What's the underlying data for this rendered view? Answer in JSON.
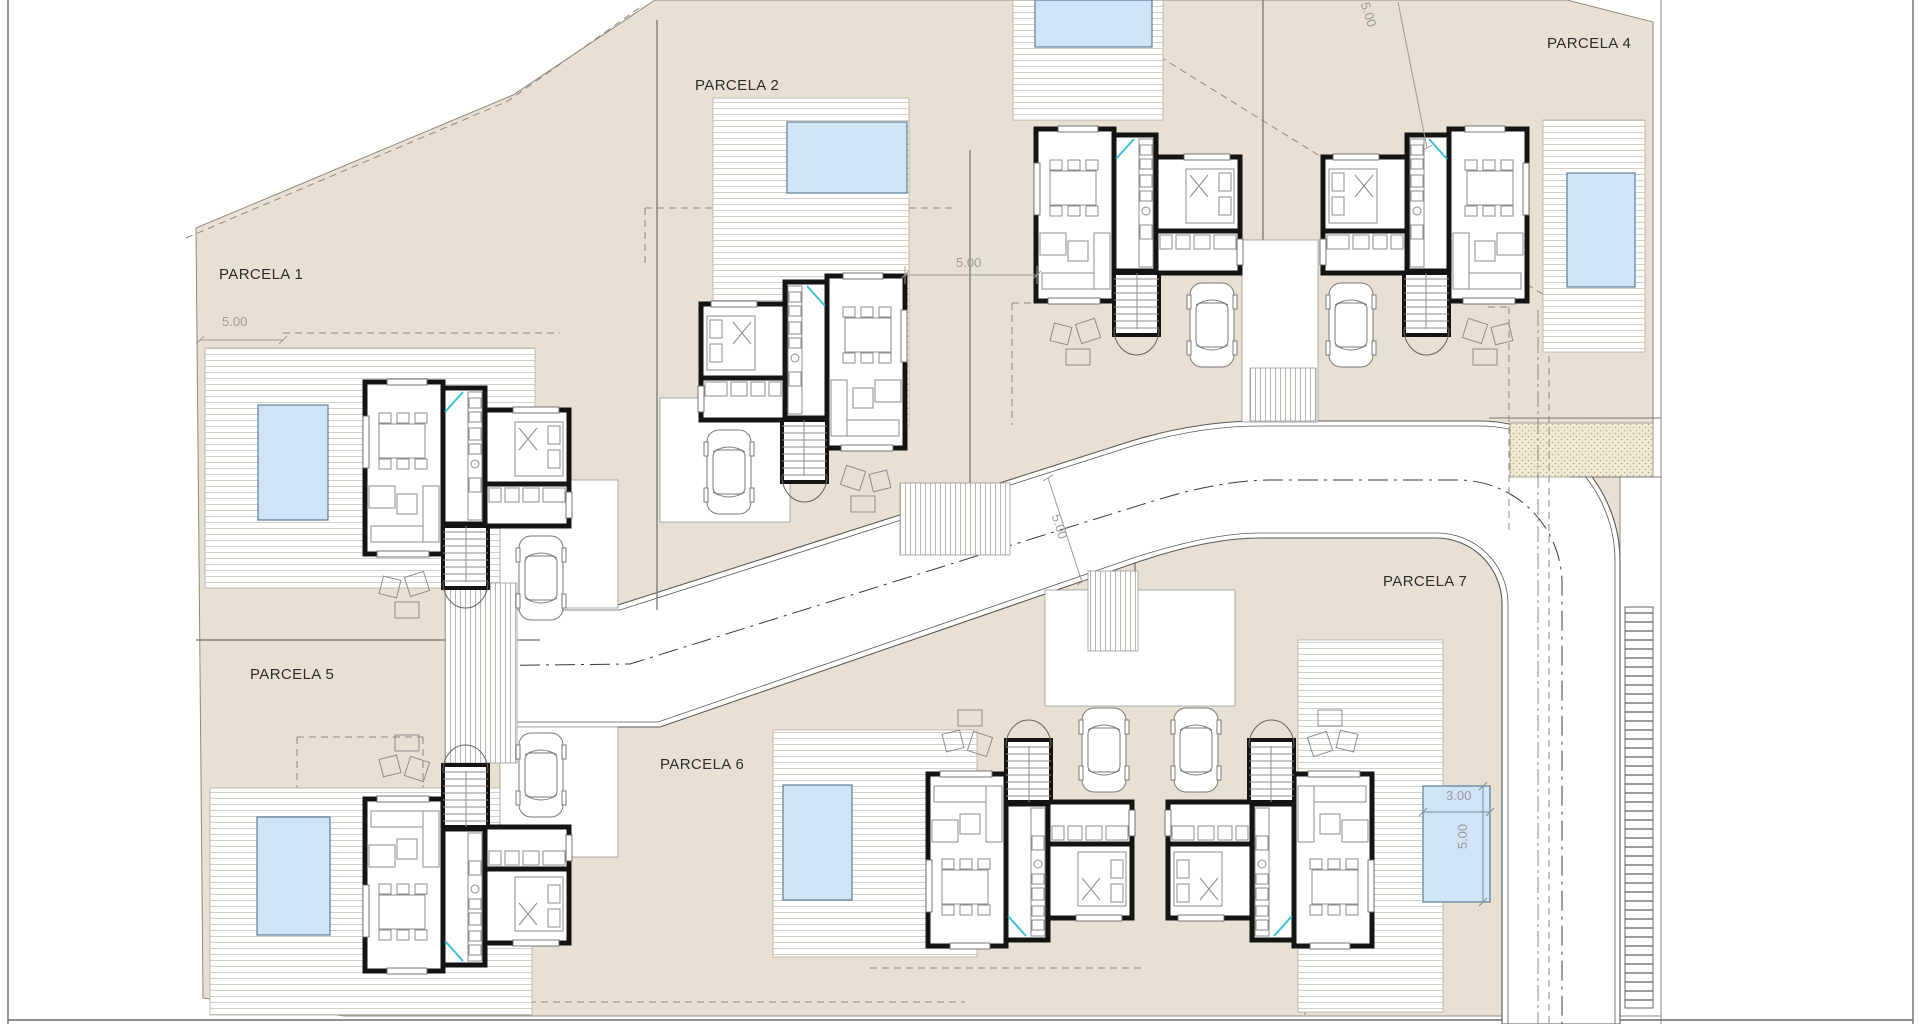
{
  "plan": {
    "title": "residential site plan",
    "parcels": [
      {
        "label": "PARCELA 1"
      },
      {
        "label": "PARCELA 2"
      },
      {
        "label": "PARCELA 4"
      },
      {
        "label": "PARCELA 5"
      },
      {
        "label": "PARCELA 6"
      },
      {
        "label": "PARCELA 7"
      }
    ],
    "dimensions": {
      "parcel1_front_setback": "5.00",
      "parcel2_side_gap": "5.00",
      "road_width": "5.00",
      "northeast_setback": "5.00",
      "pool_width": "3.00",
      "pool_length": "5.00"
    },
    "colors": {
      "parcel_fill": "#e8e1d3",
      "pool_fill": "#cfe4f6",
      "pool_border": "#5f7f96",
      "wall": "#141414",
      "road_edge": "#5a5a5a",
      "stipple_fill": "#efead6",
      "dimension_text": "#9b9b9b",
      "label_text": "#2d2d2d"
    }
  }
}
